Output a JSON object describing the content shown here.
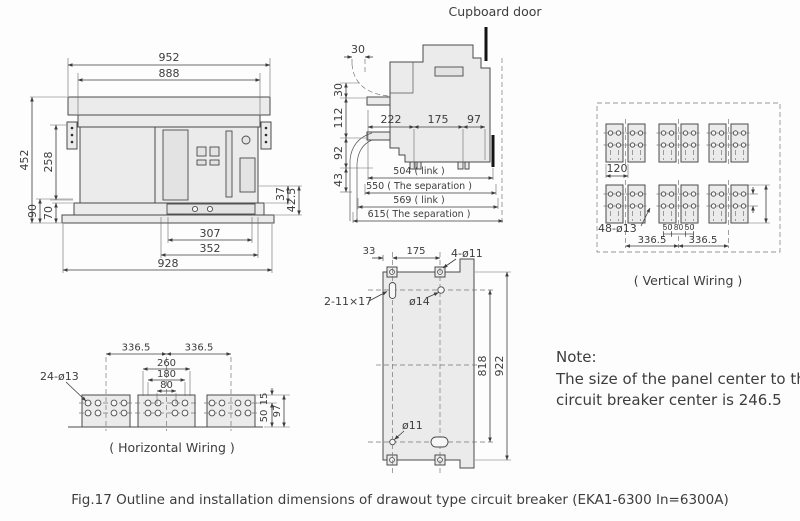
{
  "palette": {
    "line": "#4a4a4a",
    "body_fill": "#ebebeb",
    "door": "#141414",
    "background": "#fdfdfd",
    "text": "#3d3d3d"
  },
  "caption": "Fig.17 Outline and installation dimensions of drawout type circuit breaker (EKA1-6300 In=6300A)",
  "note": {
    "title": "Note:",
    "line1": "The size of the panel center to the",
    "line2": "circuit breaker center is 246.5"
  },
  "front_view": {
    "d952": "952",
    "d888": "888",
    "d452": "452",
    "d258": "258",
    "d90": "90",
    "d70": "70",
    "d37": "37",
    "d42_5": "42.5",
    "d307": "307",
    "d352": "352",
    "d928": "928"
  },
  "side_view": {
    "cupboard_door": "Cupboard door",
    "d30_top": "30",
    "d30": "30",
    "d112": "112",
    "d92": "92",
    "d43": "43",
    "d222": "222",
    "d175": "175",
    "d97": "97",
    "d504": "504 ( link )",
    "d550": "550 ( The separation )",
    "d569": "569 ( link )",
    "d615": "615( The separation )"
  },
  "vertical_wiring": {
    "label": "( Vertical Wiring )",
    "d120": "120",
    "holes": "48-ø13",
    "d50a": "50",
    "d80": "80",
    "d50b": "50",
    "d336a": "336.5",
    "d336b": "336.5"
  },
  "horizontal_wiring": {
    "label": "( Horizontal Wiring )",
    "d336a": "336.5",
    "d336b": "336.5",
    "d260": "260",
    "d180": "180",
    "d80": "80",
    "holes": "24-ø13",
    "d15": "15",
    "d50": "50",
    "d97": "97"
  },
  "mounting_plate": {
    "d33": "33",
    "d175": "175",
    "holes_top": "4-ø11",
    "slot": "2-11×17",
    "hole14": "ø14",
    "d818": "818",
    "d922": "922",
    "hole11": "ø11"
  }
}
